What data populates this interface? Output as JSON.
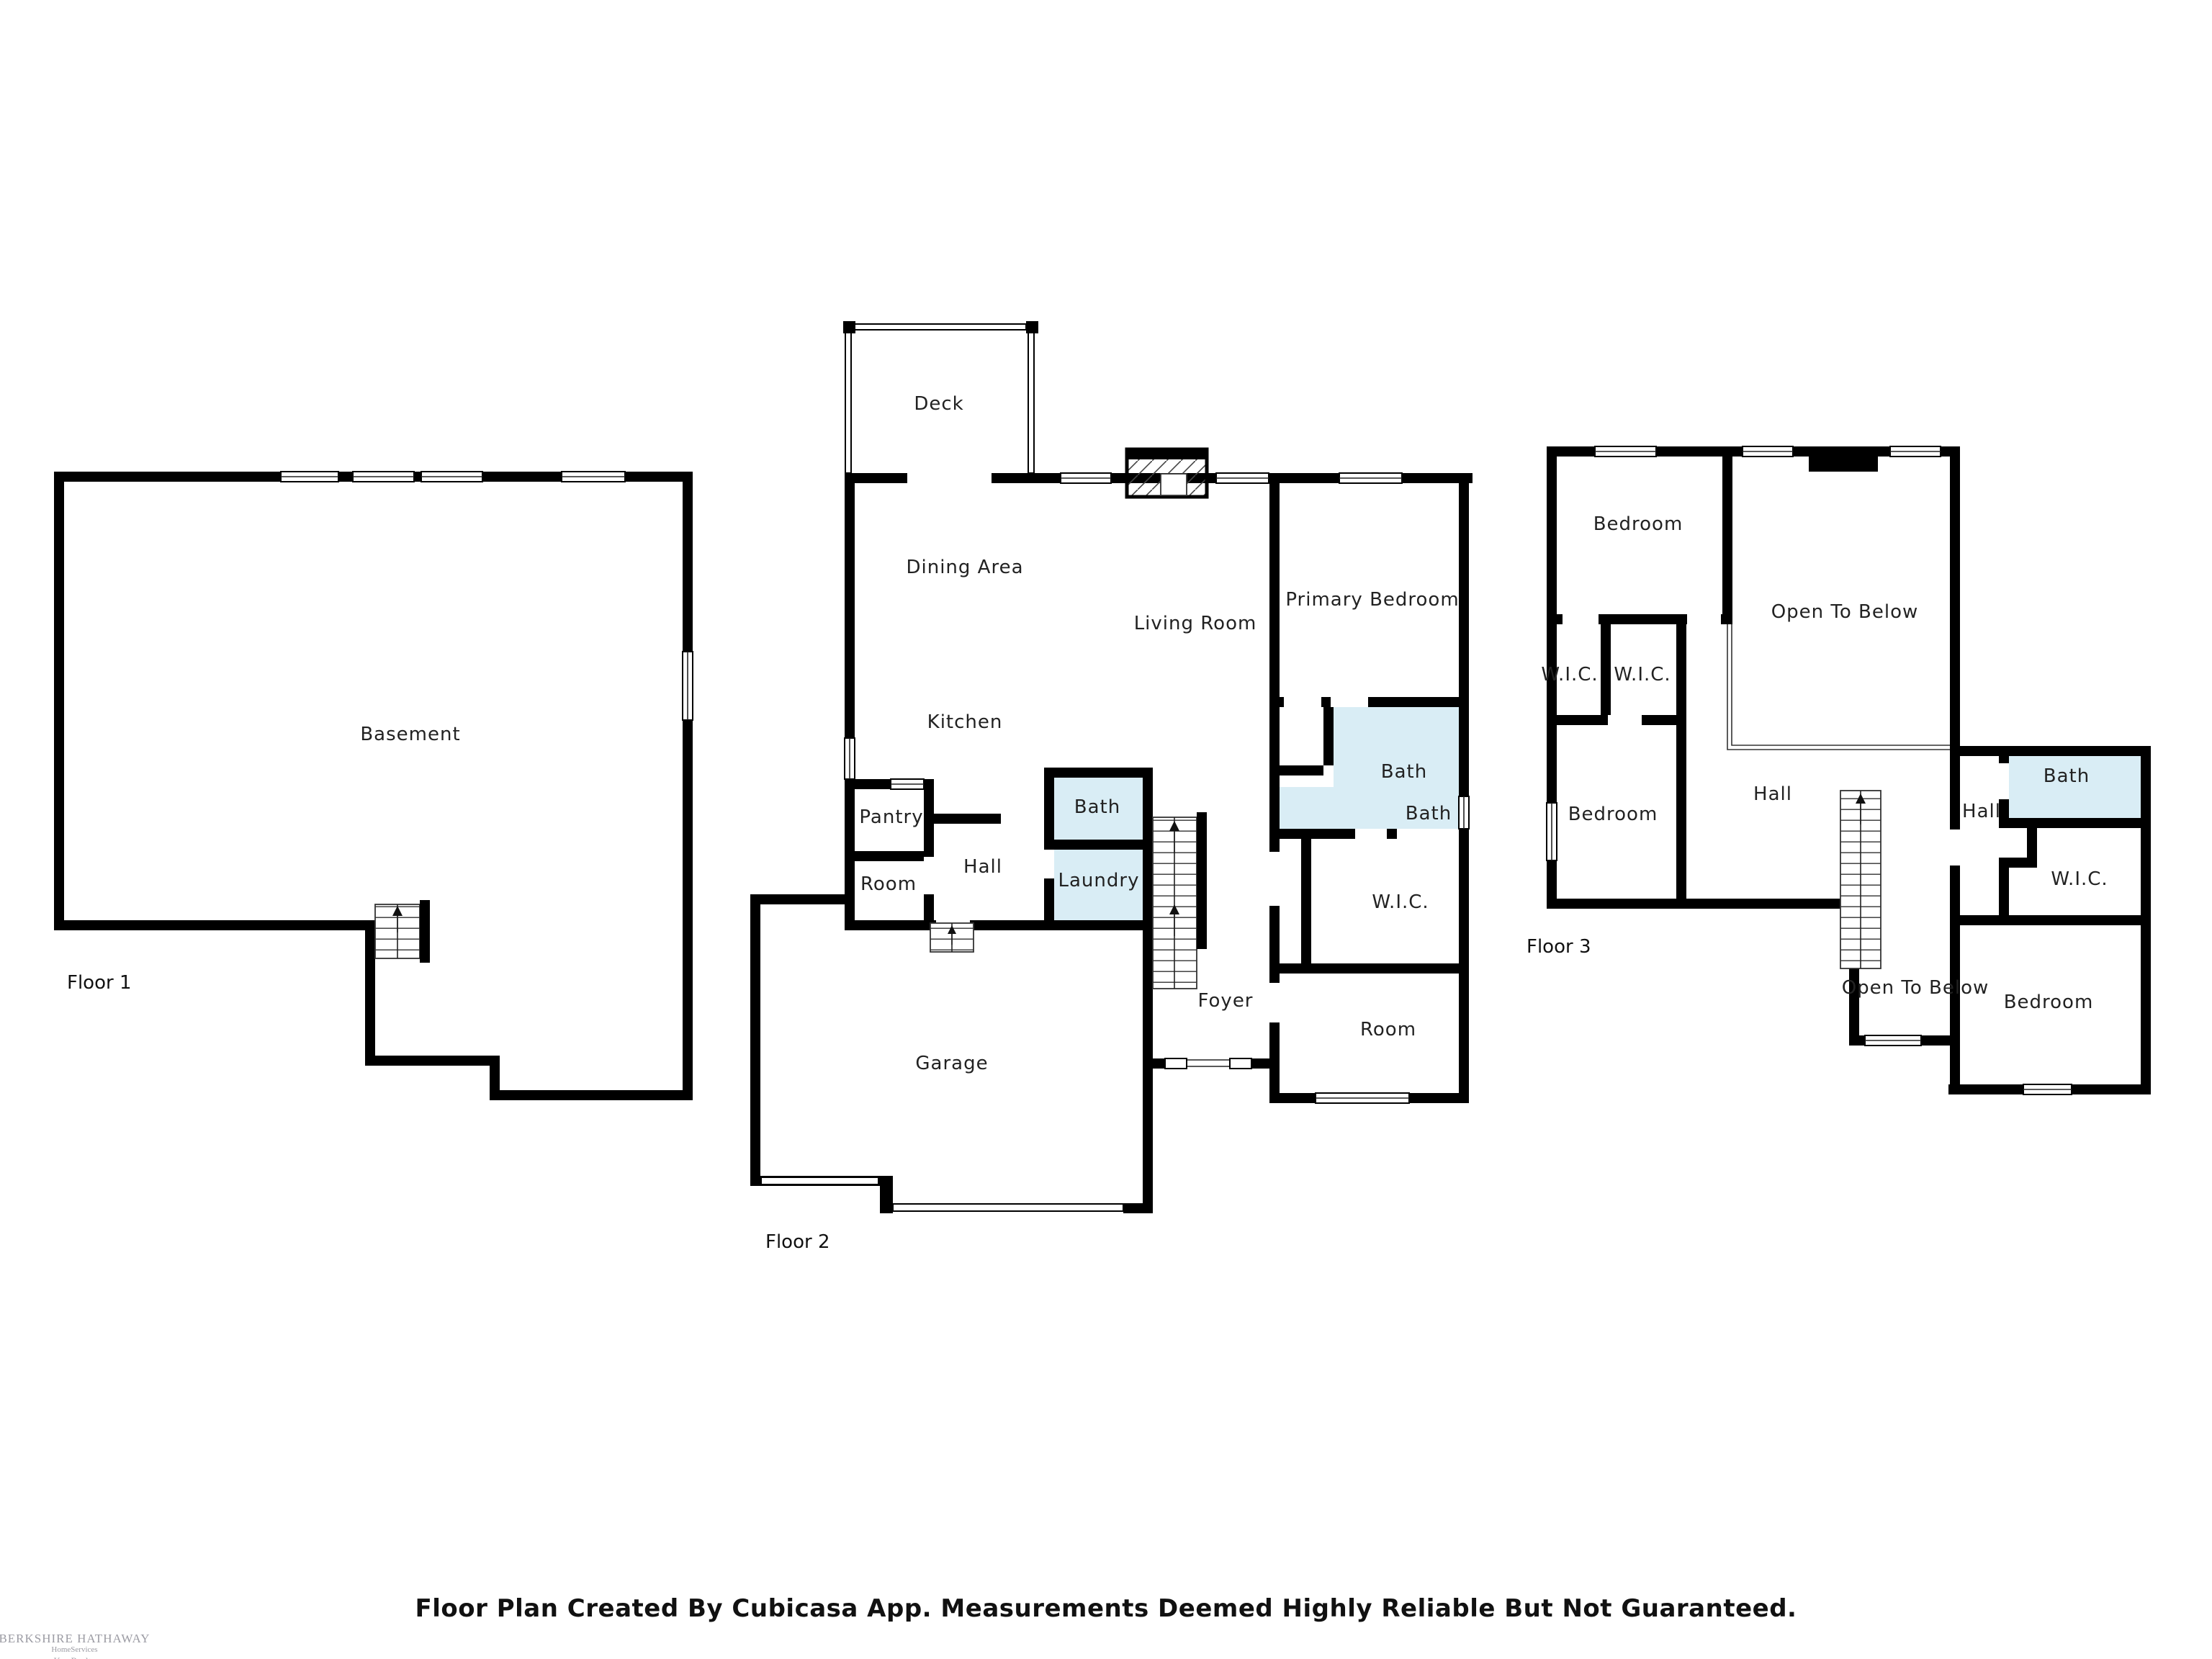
{
  "title": "Cubicasa Floor Plan",
  "disclaimer": "Floor Plan Created By Cubicasa App. Measurements Deemed Highly Reliable But Not Guaranteed.",
  "watermark": {
    "line1": "BERKSHIRE HATHAWAY",
    "line2": "HomeServices",
    "line3": "Kee Realty"
  },
  "colors": {
    "wall": "#000000",
    "bath_fill": "#d9edf5",
    "label": "#222222",
    "watermark": "#9b9ba3"
  },
  "floors": [
    {
      "name": "Floor 1",
      "rooms": [
        {
          "label": "Basement"
        }
      ]
    },
    {
      "name": "Floor 2",
      "rooms": [
        {
          "label": "Deck"
        },
        {
          "label": "Dining Area"
        },
        {
          "label": "Living Room"
        },
        {
          "label": "Kitchen"
        },
        {
          "label": "Pantry"
        },
        {
          "label": "Room"
        },
        {
          "label": "Hall"
        },
        {
          "label": "Bath"
        },
        {
          "label": "Laundry"
        },
        {
          "label": "Foyer"
        },
        {
          "label": "Garage"
        },
        {
          "label": "Primary Bedroom"
        },
        {
          "label": "Bath"
        },
        {
          "label": "Bath"
        },
        {
          "label": "W.I.C."
        },
        {
          "label": "Room"
        }
      ]
    },
    {
      "name": "Floor 3",
      "rooms": [
        {
          "label": "Bedroom"
        },
        {
          "label": "Open To Below"
        },
        {
          "label": "W.I.C."
        },
        {
          "label": "W.I.C."
        },
        {
          "label": "Bedroom"
        },
        {
          "label": "Hall"
        },
        {
          "label": "Hall"
        },
        {
          "label": "Bath"
        },
        {
          "label": "W.I.C."
        },
        {
          "label": "Open To Below"
        },
        {
          "label": "Bedroom"
        }
      ]
    }
  ]
}
